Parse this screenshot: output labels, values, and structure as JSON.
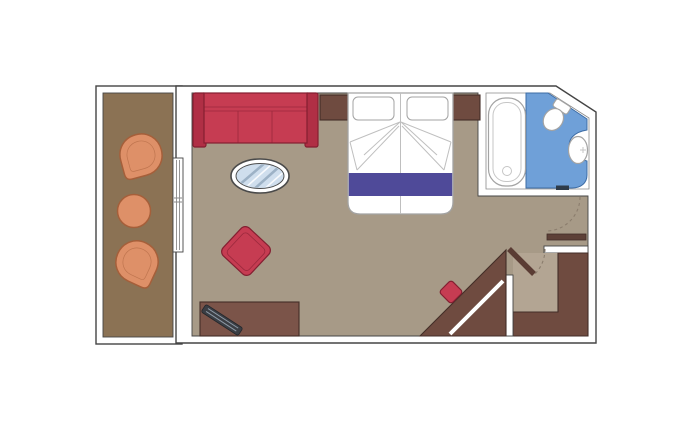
{
  "meta": {
    "kind": "cabin-floor-plan",
    "width": 700,
    "height": 433
  },
  "colors": {
    "wall_stroke": "#454545",
    "cabin_floor": "#a79a87",
    "balcony_floor": "#8b7254",
    "vestibule_floor": "#b3a593",
    "wood": "#6f4b40",
    "wood_stroke": "#432e28",
    "wood_bar": "#5d4037",
    "desk": "#7b5449",
    "furniture_red": "#c63c52",
    "furniture_red_dark": "#b02f45",
    "furniture_red_stroke": "#841f31",
    "blanket_purple": "#4f4a99",
    "bathroom_blue": "#6fa0d8",
    "bathroom_blue_stroke": "#3d6ca5",
    "fixture_stroke": "#a3a3a3",
    "balcony_orange": "#de9068",
    "balcony_orange_stroke": "#a55f3a",
    "table_glass": "#cfdeed",
    "table_stripe": "#9db2c6",
    "door_dash": "#8b7d6d",
    "door_leaf": "#5a3c34",
    "threshold": "#2e3b49",
    "tv_dark": "#3b3e44",
    "tv_stripe": "#8d99a6"
  }
}
